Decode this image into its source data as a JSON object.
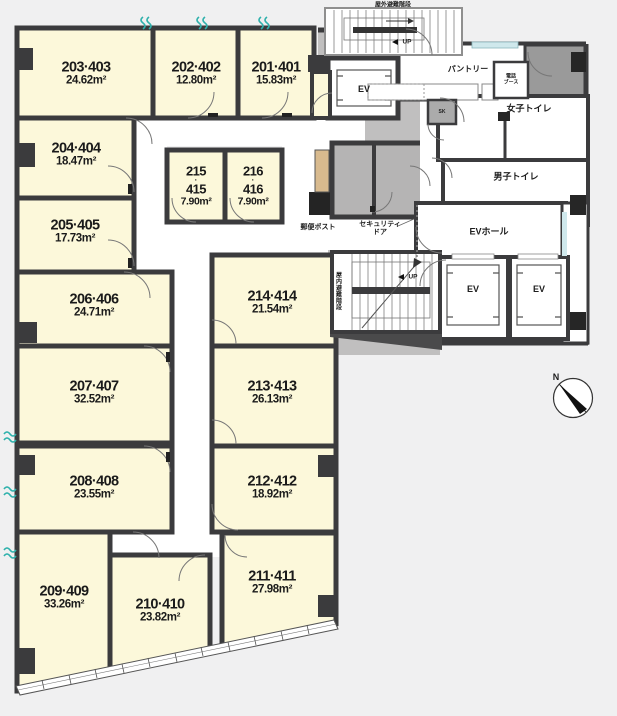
{
  "rooms": [
    {
      "label": "203·403",
      "area": "24.62m²"
    },
    {
      "label": "202·402",
      "area": "12.80m²"
    },
    {
      "label": "201·401",
      "area": "15.83m²"
    },
    {
      "label": "204·404",
      "area": "18.47m²"
    },
    {
      "label": "205·405",
      "area": "17.73m²"
    },
    {
      "label": "206·406",
      "area": "24.71m²"
    },
    {
      "label": "207·407",
      "area": "32.52m²"
    },
    {
      "label": "208·408",
      "area": "23.55m²"
    },
    {
      "label": "209·409",
      "area": "33.26m²"
    },
    {
      "label": "210·410",
      "area": "23.82m²"
    },
    {
      "label": "211·411",
      "area": "27.98m²"
    },
    {
      "label": "212·412",
      "area": "18.92m²"
    },
    {
      "label": "213·413",
      "area": "26.13m²"
    },
    {
      "label": "214·414",
      "area": "21.54m²"
    }
  ],
  "small_rooms": [
    {
      "num_top": "215",
      "dot": "·",
      "num_bottom": "415",
      "area": "7.90m²"
    },
    {
      "num_top": "216",
      "dot": "·",
      "num_bottom": "416",
      "area": "7.90m²"
    }
  ],
  "facilities": {
    "outdoor_stairs": "屋外避難階段",
    "indoor_stairs": "屋内避難階段",
    "pantry": "パントリー",
    "phone_booth_line1": "電話",
    "phone_booth_line2": "ブース",
    "sk": "SK",
    "womens_toilet": "女子トイレ",
    "mens_toilet": "男子トイレ",
    "ev": "EV",
    "ev_hall": "EVホール",
    "mail_post": "郵便ポスト",
    "security_door_line1": "セキュリティ",
    "security_door_line2": "ドア",
    "up": "UP",
    "north": "N"
  },
  "colors": {
    "room_fill": "#fcf8da",
    "wall": "#3b3b3d",
    "service_gray": "#c0bfbf",
    "window_teal": "#2fb1ac",
    "mailbox_tan": "#d8ba8e"
  }
}
